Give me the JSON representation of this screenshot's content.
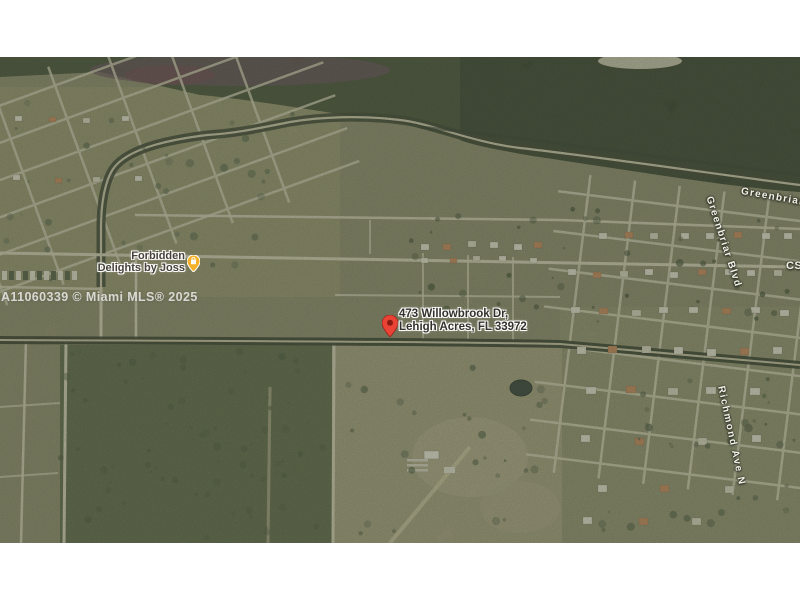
{
  "map": {
    "marker": {
      "address_line1": "473 Willowbrook Dr,",
      "address_line2": "Lehigh Acres, FL 33972"
    },
    "poi": {
      "line1": "Forbidden",
      "line2": "Delights by Joss"
    },
    "watermark": "A11060339 © Miami MLS® 2025",
    "streets": {
      "greenbriar": "Greenbriar Blvd",
      "greenbriar_vertical": "Greenbriar Blvd",
      "richmond": "Richmond Ave N",
      "edge_partial": "CS"
    },
    "colors": {
      "pin": "#EA4335",
      "pin_dot": "#8A1B12",
      "poi_icon": "#F6B129",
      "forest": "#3B472F",
      "field": "#8B8A6C",
      "road": "#D8D2BB"
    }
  }
}
